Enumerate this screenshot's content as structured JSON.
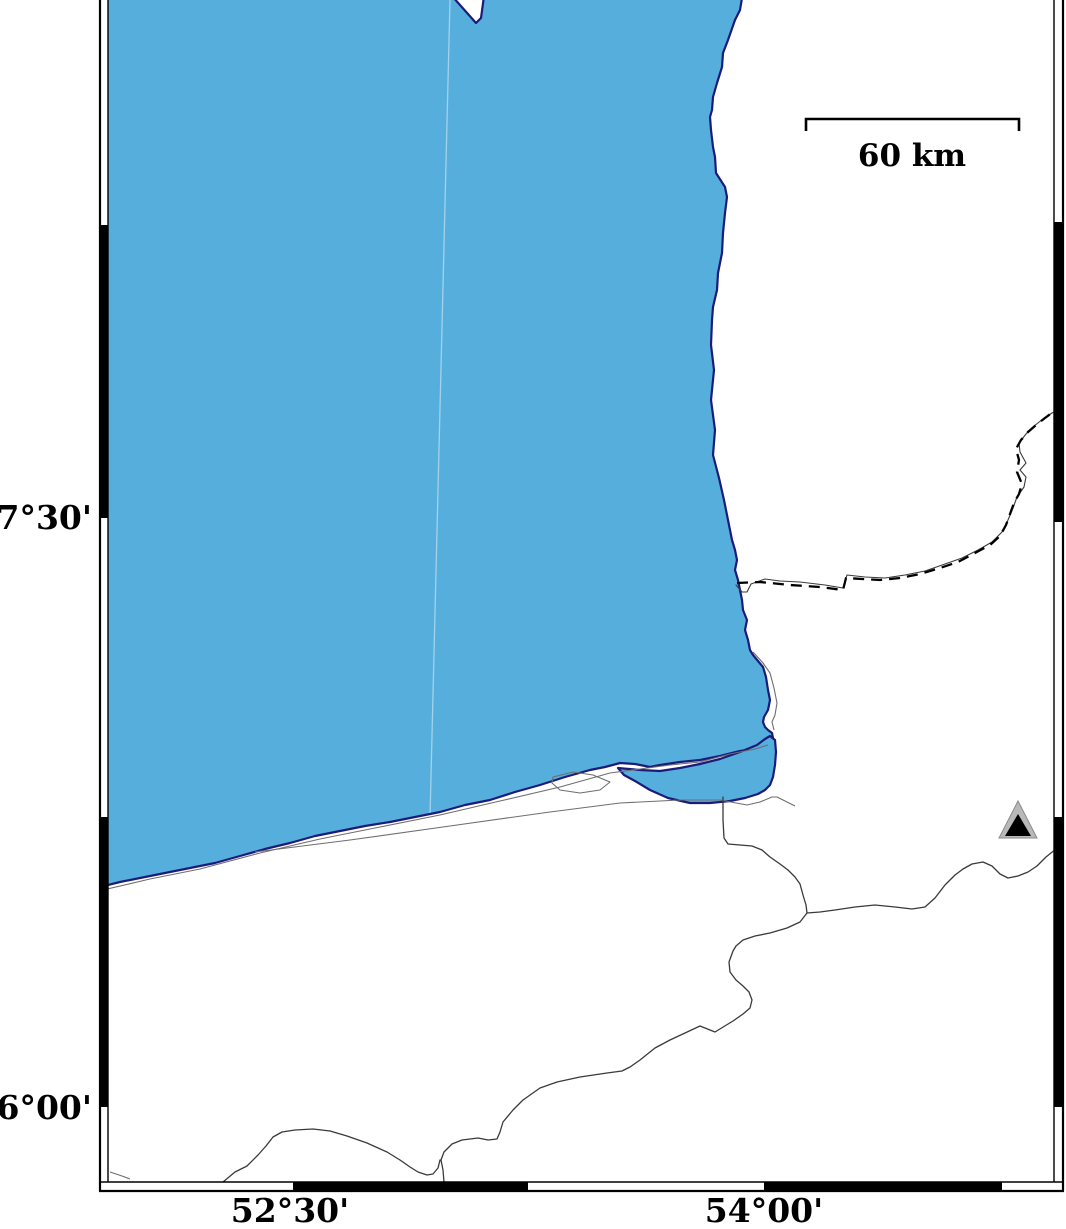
{
  "figure": {
    "type": "coastal-map",
    "water_color": "#56AEDD",
    "coastline_color": "#1B1B7A",
    "land_color": "#FFFFFF",
    "frame_color": "#000000",
    "marker_outer_color": "#B9B9B9",
    "marker_inner_color": "#000000"
  },
  "labels": {
    "lat": [
      "37°30'",
      "36°00'"
    ],
    "lon": [
      "52°30'",
      "54°00'"
    ]
  },
  "scalebar": {
    "label": "60 km"
  },
  "marker": {
    "type": "triangle",
    "name": "station-triangle"
  }
}
